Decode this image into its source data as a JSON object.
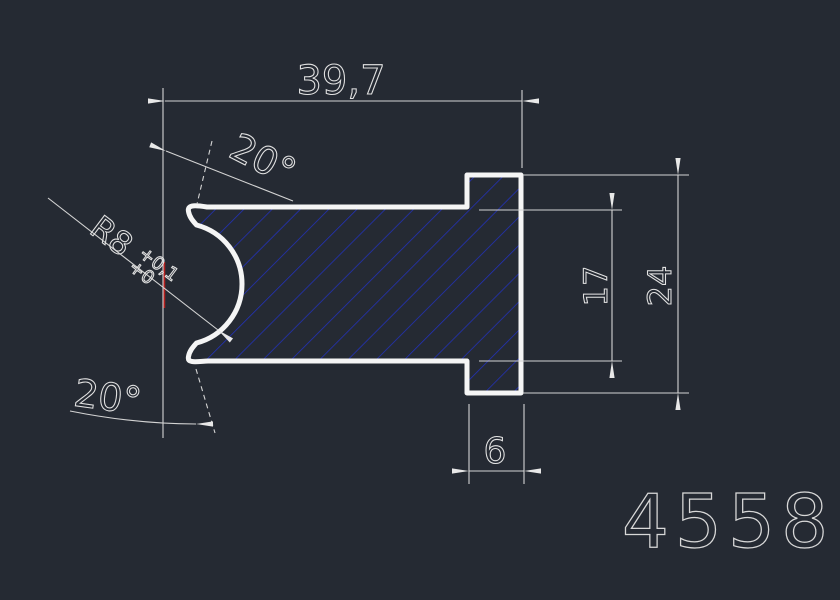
{
  "colors": {
    "background": "#252a33",
    "outline_white": "#f5f5f5",
    "dimension_lines": "#d4d4d4",
    "hatch_blue": "#2231bd",
    "centerline_red": "#b3201e",
    "dimension_text": "#e2e2e2",
    "part_number_text": "#d8d8d8"
  },
  "drawing": {
    "part_number": "4558",
    "dimensions": {
      "overall_width": "39,7",
      "top_angle": "20°",
      "bottom_angle": "20°",
      "groove_radius": "R8",
      "groove_radius_tol_upper": "+0,1",
      "groove_radius_tol_lower": "+0",
      "inner_height": "17",
      "overall_height": "24",
      "flange_thickness": "6"
    }
  }
}
